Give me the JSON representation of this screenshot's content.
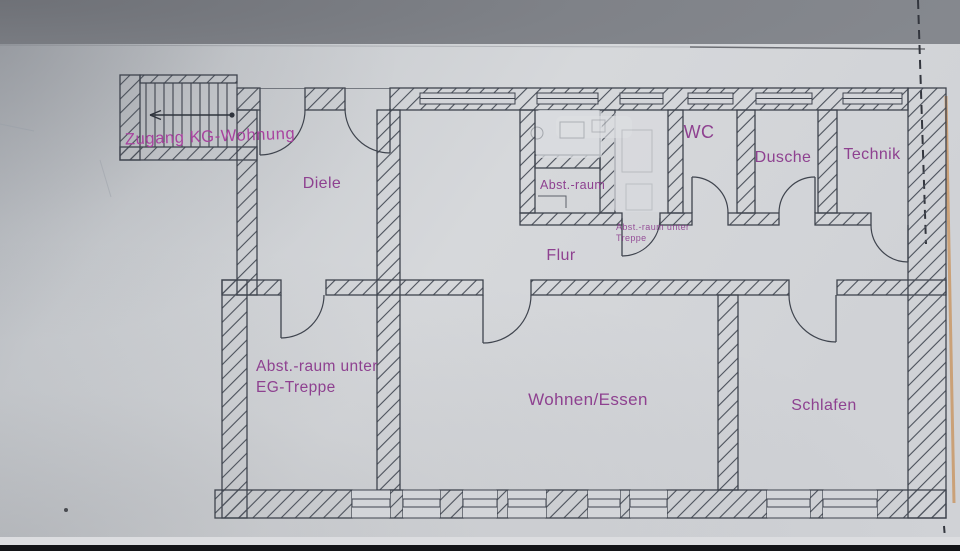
{
  "document": {
    "kind": "photographed floor plan of a basement apartment (Kellergeschoss)",
    "language": "German"
  },
  "labels": {
    "zugang": "Zugang KG-Wohnung",
    "diele": "Diele",
    "wc": "WC",
    "dusche": "Dusche",
    "technik": "Technik",
    "abstraum": "Abst.-raum",
    "abstraum_treppe_line1": "Abst.-raum unter",
    "abstraum_treppe_line2": "Treppe",
    "flur": "Flur",
    "abstraum_eg_line1": "Abst.-raum unter",
    "abstraum_eg_line2": "EG-Treppe",
    "wohnen": "Wohnen/Essen",
    "schlafen": "Schlafen"
  },
  "colors": {
    "label_text": "#8e4190",
    "entrance_label_text": "#a8439f",
    "plan_lines": "#3f444e",
    "paper": "#d3d5d9",
    "photo_background": "#85888e",
    "marker_line_orange": "#c89058"
  }
}
